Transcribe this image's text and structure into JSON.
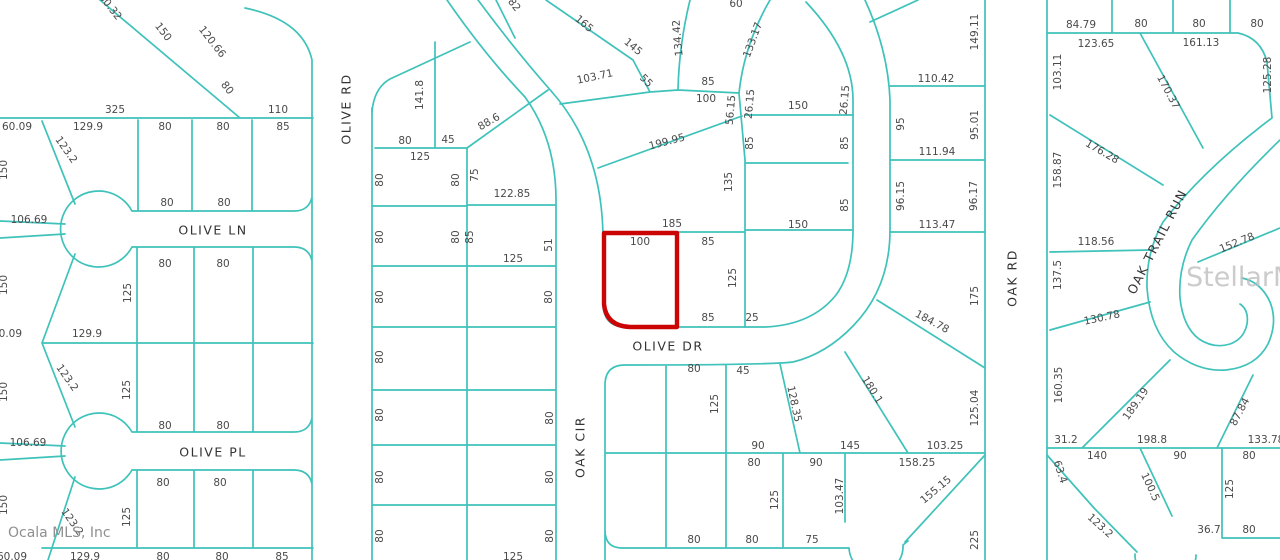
{
  "map": {
    "background": "#ffffff",
    "line_color": "#3ec2ba",
    "highlight_color": "#cb0505",
    "text_color": "#4a4a4a",
    "watermark_corner": "Ocala MLS, Inc",
    "watermark_center": "StellarMLS",
    "selected_parcel": {
      "frontage": "100",
      "depth_label": "185",
      "street": "OLIVE DR"
    },
    "streets": [
      "OLIVE LN",
      "OLIVE PL",
      "OLIVE RD",
      "OLIVE DR",
      "OAK CIR",
      "OAK RD",
      "OAK TRAIL RUN"
    ],
    "labels": [
      {
        "t": "OLIVE LN",
        "x": 213,
        "y": 231,
        "s": true
      },
      {
        "t": "OLIVE PL",
        "x": 213,
        "y": 453,
        "s": true
      },
      {
        "t": "OLIVE DR",
        "x": 668,
        "y": 347,
        "s": true
      },
      {
        "t": "OLIVE RD",
        "x": 347,
        "y": 109,
        "r": -90,
        "s": true
      },
      {
        "t": "OAK CIR",
        "x": 581,
        "y": 447,
        "r": -90,
        "s": true
      },
      {
        "t": "OAK RD",
        "x": 1013,
        "y": 278,
        "r": -90,
        "s": true
      },
      {
        "t": "OAK TRAIL RUN",
        "x": 1158,
        "y": 242,
        "r": -63,
        "s": true
      },
      {
        "t": "60.32",
        "x": 110,
        "y": 7,
        "r": 52
      },
      {
        "t": "150",
        "x": 163,
        "y": 32,
        "r": 52
      },
      {
        "t": "120.66",
        "x": 212,
        "y": 42,
        "r": 52
      },
      {
        "t": "80",
        "x": 227,
        "y": 88,
        "r": 52
      },
      {
        "t": "325",
        "x": 115,
        "y": 110
      },
      {
        "t": "110",
        "x": 278,
        "y": 110
      },
      {
        "t": "60.09",
        "x": 17,
        "y": 127
      },
      {
        "t": "129.9",
        "x": 88,
        "y": 127
      },
      {
        "t": "80",
        "x": 165,
        "y": 127
      },
      {
        "t": "80",
        "x": 223,
        "y": 127
      },
      {
        "t": "85",
        "x": 283,
        "y": 127
      },
      {
        "t": "150",
        "x": 4,
        "y": 170,
        "r": -90
      },
      {
        "t": "150",
        "x": 4,
        "y": 285,
        "r": -90
      },
      {
        "t": "150",
        "x": 4,
        "y": 392,
        "r": -90
      },
      {
        "t": "150",
        "x": 4,
        "y": 505,
        "r": -90
      },
      {
        "t": "123.2",
        "x": 66,
        "y": 150,
        "r": 55
      },
      {
        "t": "123.2",
        "x": 67,
        "y": 378,
        "r": 55
      },
      {
        "t": "123.2",
        "x": 72,
        "y": 522,
        "r": 55
      },
      {
        "t": "106.69",
        "x": 29,
        "y": 220
      },
      {
        "t": "106.69",
        "x": 28,
        "y": 443
      },
      {
        "t": "80",
        "x": 167,
        "y": 203
      },
      {
        "t": "80",
        "x": 224,
        "y": 203
      },
      {
        "t": "80",
        "x": 165,
        "y": 264
      },
      {
        "t": "80",
        "x": 223,
        "y": 264
      },
      {
        "t": "125",
        "x": 128,
        "y": 293,
        "r": -90
      },
      {
        "t": "60.09",
        "x": 7,
        "y": 334
      },
      {
        "t": "129.9",
        "x": 87,
        "y": 334
      },
      {
        "t": "125",
        "x": 127,
        "y": 390,
        "r": -90
      },
      {
        "t": "80",
        "x": 165,
        "y": 426
      },
      {
        "t": "80",
        "x": 223,
        "y": 426
      },
      {
        "t": "80",
        "x": 163,
        "y": 483
      },
      {
        "t": "80",
        "x": 220,
        "y": 483
      },
      {
        "t": "125",
        "x": 127,
        "y": 517,
        "r": -90
      },
      {
        "t": "60.09",
        "x": 12,
        "y": 557
      },
      {
        "t": "129.9",
        "x": 85,
        "y": 557
      },
      {
        "t": "80",
        "x": 163,
        "y": 557
      },
      {
        "t": "80",
        "x": 222,
        "y": 557
      },
      {
        "t": "85",
        "x": 282,
        "y": 557
      },
      {
        "t": "141.8",
        "x": 420,
        "y": 95,
        "r": -90
      },
      {
        "t": "80",
        "x": 405,
        "y": 141
      },
      {
        "t": "45",
        "x": 448,
        "y": 140
      },
      {
        "t": "125",
        "x": 420,
        "y": 157
      },
      {
        "t": "88.6",
        "x": 489,
        "y": 122,
        "r": -30
      },
      {
        "t": "75",
        "x": 475,
        "y": 175,
        "r": -90
      },
      {
        "t": "122.85",
        "x": 512,
        "y": 194
      },
      {
        "t": "85",
        "x": 470,
        "y": 237,
        "r": -90
      },
      {
        "t": "125",
        "x": 513,
        "y": 259
      },
      {
        "t": "51",
        "x": 549,
        "y": 245,
        "r": -90
      },
      {
        "t": "80",
        "x": 380,
        "y": 180,
        "r": -90
      },
      {
        "t": "80",
        "x": 456,
        "y": 180,
        "r": -90
      },
      {
        "t": "80",
        "x": 380,
        "y": 237,
        "r": -90
      },
      {
        "t": "80",
        "x": 456,
        "y": 237,
        "r": -90
      },
      {
        "t": "80",
        "x": 380,
        "y": 297,
        "r": -90
      },
      {
        "t": "80",
        "x": 549,
        "y": 297,
        "r": -90
      },
      {
        "t": "80",
        "x": 380,
        "y": 357,
        "r": -90
      },
      {
        "t": "80",
        "x": 380,
        "y": 415,
        "r": -90
      },
      {
        "t": "80",
        "x": 550,
        "y": 418,
        "r": -90
      },
      {
        "t": "80",
        "x": 380,
        "y": 477,
        "r": -90
      },
      {
        "t": "80",
        "x": 550,
        "y": 477,
        "r": -90
      },
      {
        "t": "80",
        "x": 380,
        "y": 536,
        "r": -90
      },
      {
        "t": "80",
        "x": 550,
        "y": 536,
        "r": -90
      },
      {
        "t": "125",
        "x": 513,
        "y": 557
      },
      {
        "t": "82",
        "x": 514,
        "y": 5,
        "r": 52
      },
      {
        "t": "165",
        "x": 584,
        "y": 24,
        "r": 40
      },
      {
        "t": "145",
        "x": 633,
        "y": 47,
        "r": 40
      },
      {
        "t": "134.42",
        "x": 678,
        "y": 38,
        "r": -95
      },
      {
        "t": "133.17",
        "x": 753,
        "y": 40,
        "r": -70
      },
      {
        "t": "60",
        "x": 736,
        "y": 4
      },
      {
        "t": "103.71",
        "x": 595,
        "y": 77,
        "r": -12
      },
      {
        "t": "55",
        "x": 646,
        "y": 81,
        "r": 45
      },
      {
        "t": "85",
        "x": 708,
        "y": 82
      },
      {
        "t": "100",
        "x": 706,
        "y": 99
      },
      {
        "t": "56.15",
        "x": 731,
        "y": 110,
        "r": -85
      },
      {
        "t": "26.15",
        "x": 750,
        "y": 104,
        "r": -85
      },
      {
        "t": "150",
        "x": 798,
        "y": 106
      },
      {
        "t": "199.95",
        "x": 667,
        "y": 142,
        "r": -15
      },
      {
        "t": "85",
        "x": 750,
        "y": 143,
        "r": -90
      },
      {
        "t": "26.15",
        "x": 845,
        "y": 100,
        "r": -85
      },
      {
        "t": "85",
        "x": 845,
        "y": 143,
        "r": -90
      },
      {
        "t": "85",
        "x": 845,
        "y": 205,
        "r": -90
      },
      {
        "t": "135",
        "x": 729,
        "y": 182,
        "r": -90
      },
      {
        "t": "185",
        "x": 672,
        "y": 224
      },
      {
        "t": "150",
        "x": 798,
        "y": 225
      },
      {
        "t": "100",
        "x": 640,
        "y": 242
      },
      {
        "t": "85",
        "x": 708,
        "y": 242
      },
      {
        "t": "125",
        "x": 733,
        "y": 278,
        "r": -90
      },
      {
        "t": "85",
        "x": 708,
        "y": 318
      },
      {
        "t": "25",
        "x": 752,
        "y": 318
      },
      {
        "t": "110.42",
        "x": 936,
        "y": 79
      },
      {
        "t": "149.11",
        "x": 975,
        "y": 32,
        "r": -90
      },
      {
        "t": "95",
        "x": 901,
        "y": 124,
        "r": -90
      },
      {
        "t": "95.01",
        "x": 975,
        "y": 125,
        "r": -90
      },
      {
        "t": "111.94",
        "x": 937,
        "y": 152
      },
      {
        "t": "96.15",
        "x": 901,
        "y": 196,
        "r": -90
      },
      {
        "t": "96.17",
        "x": 974,
        "y": 196,
        "r": -90
      },
      {
        "t": "113.47",
        "x": 937,
        "y": 225
      },
      {
        "t": "175",
        "x": 975,
        "y": 296,
        "r": -90
      },
      {
        "t": "184.78",
        "x": 932,
        "y": 322,
        "r": 28
      },
      {
        "t": "180.1",
        "x": 872,
        "y": 390,
        "r": 58
      },
      {
        "t": "128.35",
        "x": 794,
        "y": 404,
        "r": 78
      },
      {
        "t": "125.04",
        "x": 975,
        "y": 408,
        "r": -90
      },
      {
        "t": "145",
        "x": 850,
        "y": 446
      },
      {
        "t": "103.25",
        "x": 945,
        "y": 446
      },
      {
        "t": "90",
        "x": 758,
        "y": 446
      },
      {
        "t": "80",
        "x": 754,
        "y": 463
      },
      {
        "t": "90",
        "x": 816,
        "y": 463
      },
      {
        "t": "158.25",
        "x": 917,
        "y": 463
      },
      {
        "t": "103.47",
        "x": 840,
        "y": 496,
        "r": -90
      },
      {
        "t": "155.15",
        "x": 936,
        "y": 490,
        "r": -40
      },
      {
        "t": "125",
        "x": 775,
        "y": 500,
        "r": -90
      },
      {
        "t": "225",
        "x": 975,
        "y": 540,
        "r": -90
      },
      {
        "t": "80",
        "x": 694,
        "y": 369
      },
      {
        "t": "45",
        "x": 743,
        "y": 371
      },
      {
        "t": "125",
        "x": 715,
        "y": 404,
        "r": -90
      },
      {
        "t": "80",
        "x": 694,
        "y": 540
      },
      {
        "t": "80",
        "x": 752,
        "y": 540
      },
      {
        "t": "75",
        "x": 812,
        "y": 540
      },
      {
        "t": "84.79",
        "x": 1081,
        "y": 25
      },
      {
        "t": "80",
        "x": 1141,
        "y": 24
      },
      {
        "t": "80",
        "x": 1199,
        "y": 24
      },
      {
        "t": "80",
        "x": 1257,
        "y": 24
      },
      {
        "t": "123.65",
        "x": 1096,
        "y": 44
      },
      {
        "t": "161.13",
        "x": 1201,
        "y": 43
      },
      {
        "t": "103.11",
        "x": 1058,
        "y": 72,
        "r": -90
      },
      {
        "t": "170.37",
        "x": 1168,
        "y": 92,
        "r": 62
      },
      {
        "t": "125.28",
        "x": 1268,
        "y": 75,
        "r": -90
      },
      {
        "t": "176.28",
        "x": 1102,
        "y": 152,
        "r": 30
      },
      {
        "t": "158.87",
        "x": 1058,
        "y": 170,
        "r": -90
      },
      {
        "t": "152.78",
        "x": 1237,
        "y": 243,
        "r": -22
      },
      {
        "t": "118.56",
        "x": 1096,
        "y": 242
      },
      {
        "t": "137.5",
        "x": 1058,
        "y": 275,
        "r": -90
      },
      {
        "t": "130.78",
        "x": 1102,
        "y": 318,
        "r": -12
      },
      {
        "t": "160.35",
        "x": 1059,
        "y": 385,
        "r": -90
      },
      {
        "t": "189.19",
        "x": 1136,
        "y": 404,
        "r": -55
      },
      {
        "t": "87.84",
        "x": 1240,
        "y": 412,
        "r": -62
      },
      {
        "t": "31.2",
        "x": 1066,
        "y": 440
      },
      {
        "t": "198.8",
        "x": 1152,
        "y": 440
      },
      {
        "t": "133.78",
        "x": 1266,
        "y": 440
      },
      {
        "t": "140",
        "x": 1097,
        "y": 456
      },
      {
        "t": "90",
        "x": 1180,
        "y": 456
      },
      {
        "t": "80",
        "x": 1249,
        "y": 456
      },
      {
        "t": "63.4",
        "x": 1060,
        "y": 472,
        "r": 72
      },
      {
        "t": "100.5",
        "x": 1150,
        "y": 487,
        "r": 65
      },
      {
        "t": "125",
        "x": 1230,
        "y": 489,
        "r": -90
      },
      {
        "t": "123.2",
        "x": 1100,
        "y": 526,
        "r": 42
      },
      {
        "t": "36.7",
        "x": 1209,
        "y": 530
      },
      {
        "t": "80",
        "x": 1249,
        "y": 530
      }
    ]
  }
}
